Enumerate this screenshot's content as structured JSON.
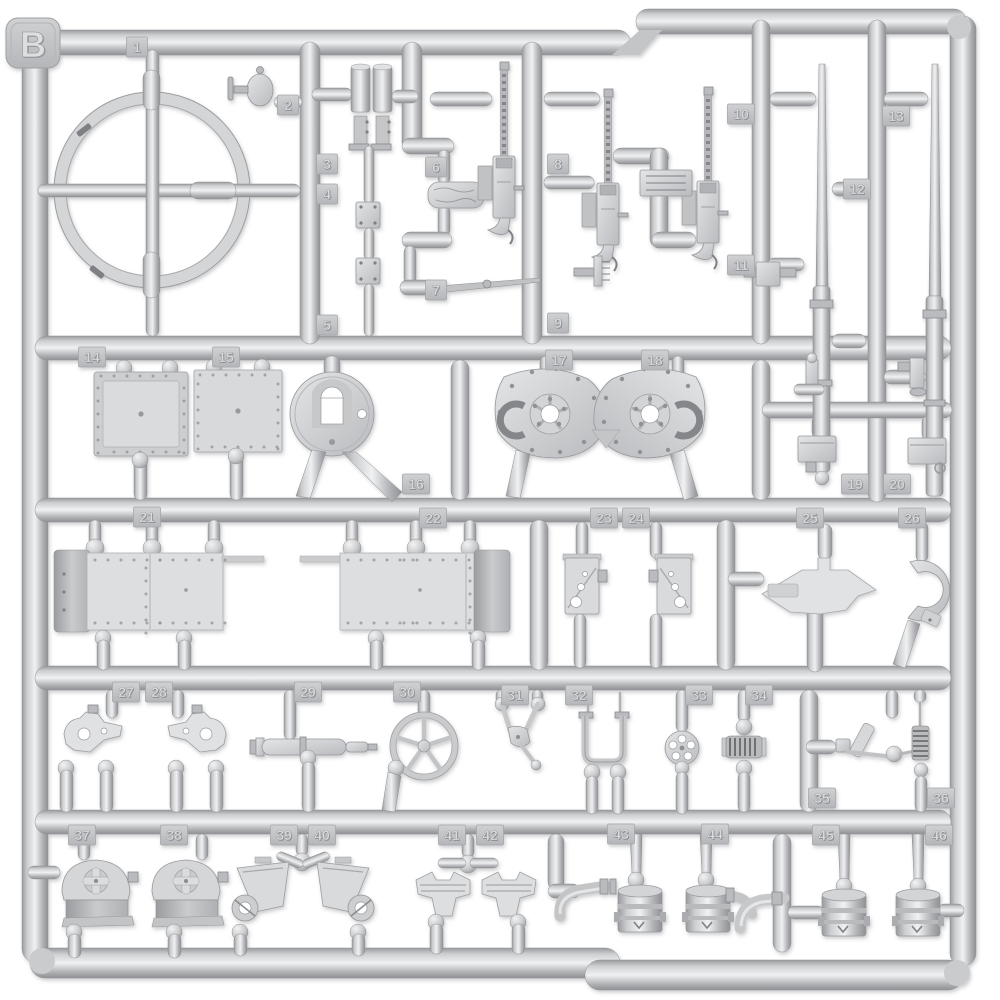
{
  "photo": {
    "subject": "injection-molded model kit sprue photographed on white",
    "background_color": "#ffffff",
    "plastic_color": "#c9cbcd",
    "plastic_highlight": "#eff0f1",
    "plastic_shadow": "#94969a",
    "tab_color": "#c3c5c7"
  },
  "sprue": {
    "label": "B",
    "part_count": 46,
    "tabs": [
      {
        "n": "1",
        "x": 137,
        "y": 47
      },
      {
        "n": "2",
        "x": 288,
        "y": 105
      },
      {
        "n": "3",
        "x": 327,
        "y": 164
      },
      {
        "n": "4",
        "x": 327,
        "y": 194
      },
      {
        "n": "5",
        "x": 327,
        "y": 325
      },
      {
        "n": "6",
        "x": 436,
        "y": 167
      },
      {
        "n": "7",
        "x": 436,
        "y": 290
      },
      {
        "n": "8",
        "x": 558,
        "y": 164
      },
      {
        "n": "9",
        "x": 558,
        "y": 323
      },
      {
        "n": "10",
        "x": 741,
        "y": 114
      },
      {
        "n": "11",
        "x": 741,
        "y": 265
      },
      {
        "n": "12",
        "x": 857,
        "y": 189
      },
      {
        "n": "13",
        "x": 896,
        "y": 116
      },
      {
        "n": "14",
        "x": 92,
        "y": 357
      },
      {
        "n": "15",
        "x": 226,
        "y": 357
      },
      {
        "n": "16",
        "x": 416,
        "y": 484
      },
      {
        "n": "17",
        "x": 559,
        "y": 360
      },
      {
        "n": "18",
        "x": 655,
        "y": 360
      },
      {
        "n": "19",
        "x": 855,
        "y": 484
      },
      {
        "n": "20",
        "x": 897,
        "y": 484
      },
      {
        "n": "21",
        "x": 147,
        "y": 517
      },
      {
        "n": "22",
        "x": 433,
        "y": 518
      },
      {
        "n": "23",
        "x": 604,
        "y": 518
      },
      {
        "n": "24",
        "x": 636,
        "y": 518
      },
      {
        "n": "25",
        "x": 810,
        "y": 518
      },
      {
        "n": "26",
        "x": 912,
        "y": 518
      },
      {
        "n": "27",
        "x": 126,
        "y": 692
      },
      {
        "n": "28",
        "x": 159,
        "y": 692
      },
      {
        "n": "29",
        "x": 308,
        "y": 692
      },
      {
        "n": "30",
        "x": 407,
        "y": 692
      },
      {
        "n": "31",
        "x": 515,
        "y": 695
      },
      {
        "n": "32",
        "x": 579,
        "y": 695
      },
      {
        "n": "33",
        "x": 699,
        "y": 695
      },
      {
        "n": "34",
        "x": 759,
        "y": 695
      },
      {
        "n": "35",
        "x": 822,
        "y": 798
      },
      {
        "n": "36",
        "x": 941,
        "y": 798
      },
      {
        "n": "37",
        "x": 82,
        "y": 835
      },
      {
        "n": "38",
        "x": 174,
        "y": 835
      },
      {
        "n": "39",
        "x": 284,
        "y": 835
      },
      {
        "n": "40",
        "x": 322,
        "y": 835
      },
      {
        "n": "41",
        "x": 452,
        "y": 835
      },
      {
        "n": "42",
        "x": 490,
        "y": 835
      },
      {
        "n": "43",
        "x": 621,
        "y": 834
      },
      {
        "n": "44",
        "x": 715,
        "y": 834
      },
      {
        "n": "45",
        "x": 826,
        "y": 835
      },
      {
        "n": "46",
        "x": 939,
        "y": 835
      }
    ]
  }
}
